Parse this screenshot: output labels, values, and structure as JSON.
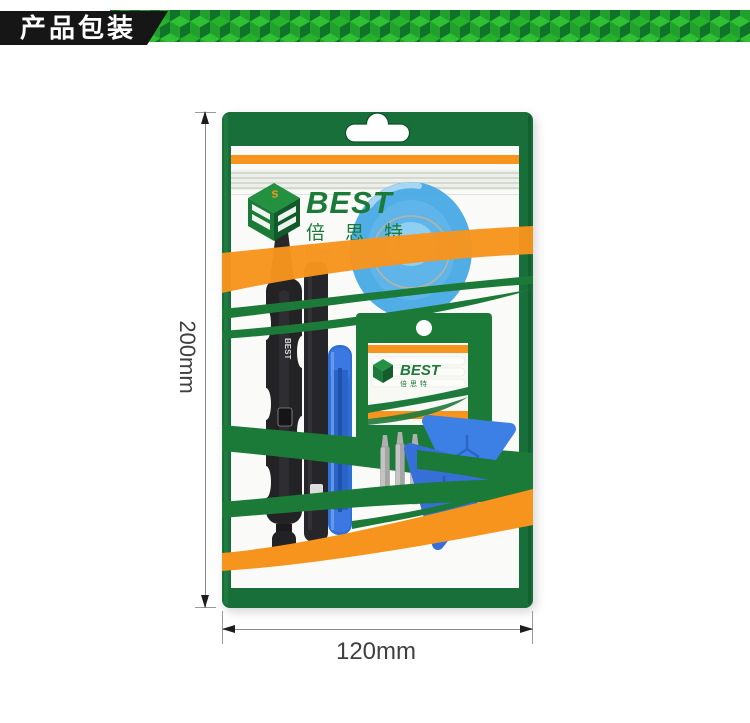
{
  "banner": {
    "title": "产品包装",
    "colors": {
      "label_bg": "#161616",
      "label_text": "#ffffff",
      "cube_top": "#2FC034",
      "cube_top_alt": "#27B22C",
      "cube_left": "#21A02E",
      "cube_right": "#0F7429"
    }
  },
  "annotations": {
    "height_label": "200mm",
    "width_label": "120mm"
  },
  "package": {
    "brand": "BEST",
    "brand_cn": "倍思特",
    "logo_cube_top_letter": "s",
    "tool_print": "BEST",
    "inner_packet": {
      "brand": "BEST",
      "brand_cn": "倍思特"
    },
    "colors": {
      "bag_green": "#186F39",
      "swoosh_green": "#1C7A38",
      "stripe_orange": "#F7941D",
      "pry_blue": "#2E6FD8",
      "pick_blue": "#3C80E6",
      "cup_blue": "#47A9E4"
    }
  }
}
